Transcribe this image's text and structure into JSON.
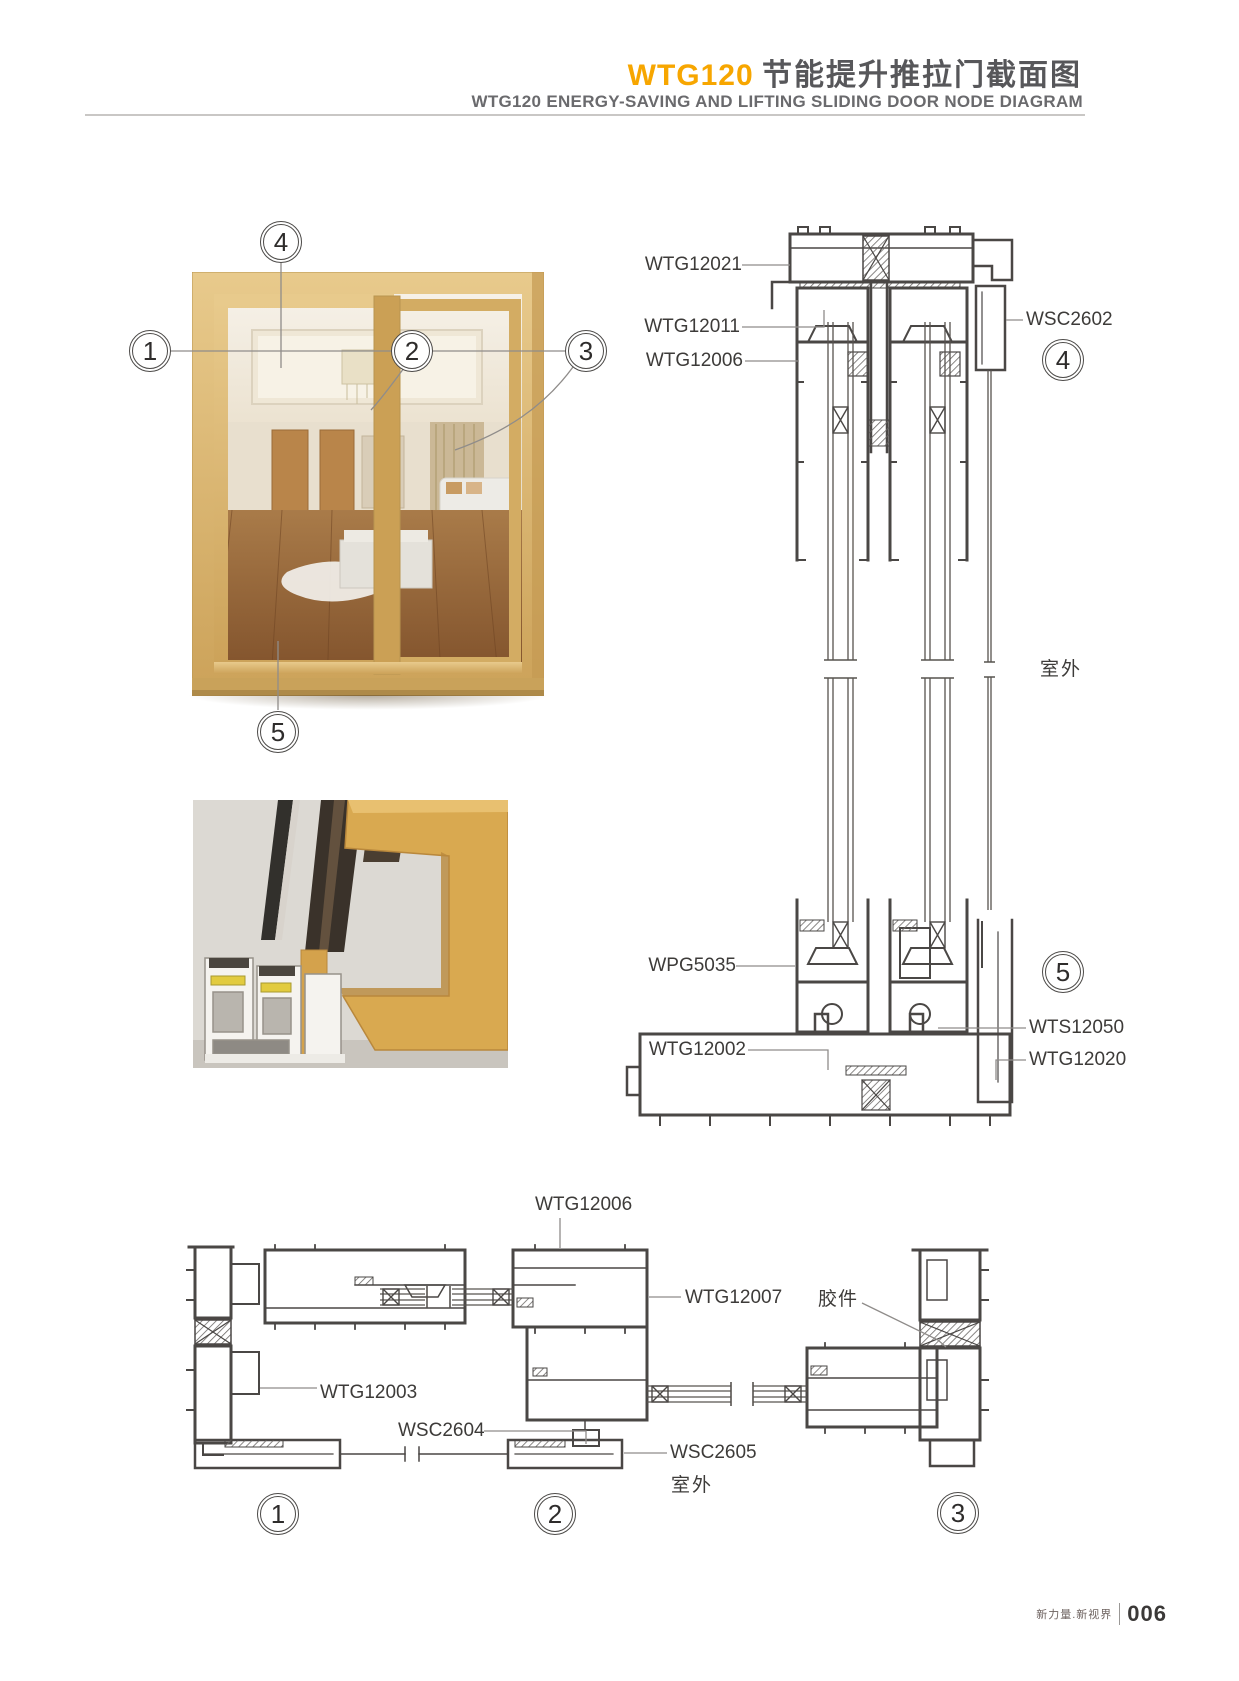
{
  "header": {
    "title_code": "WTG120",
    "title_cn": "节能提升推拉门截面图",
    "subtitle": "WTG120 ENERGY-SAVING AND LIFTING SLIDING DOOR NODE DIAGRAM"
  },
  "callout_numbers": {
    "c1": "1",
    "c2": "2",
    "c3": "3",
    "c4": "4",
    "c5": "5"
  },
  "vertical_section": {
    "labels": {
      "wtg12021": "WTG12021",
      "wtg12011": "WTG12011",
      "wtg12006": "WTG12006",
      "wsc2602": "WSC2602",
      "wpg5035": "WPG5035",
      "wtg12002": "WTG12002",
      "wts12050": "WTS12050",
      "wtg12020": "WTG12020",
      "outdoor": "室外"
    }
  },
  "horizontal_section": {
    "labels": {
      "wtg12006": "WTG12006",
      "wtg12007": "WTG12007",
      "rubber_part": "胶件",
      "wtg12003": "WTG12003",
      "wsc2604": "WSC2604",
      "wsc2605": "WSC2605",
      "outdoor": "室外"
    }
  },
  "footer": {
    "slogan": "新力量.新视界",
    "page_number": "006"
  }
}
